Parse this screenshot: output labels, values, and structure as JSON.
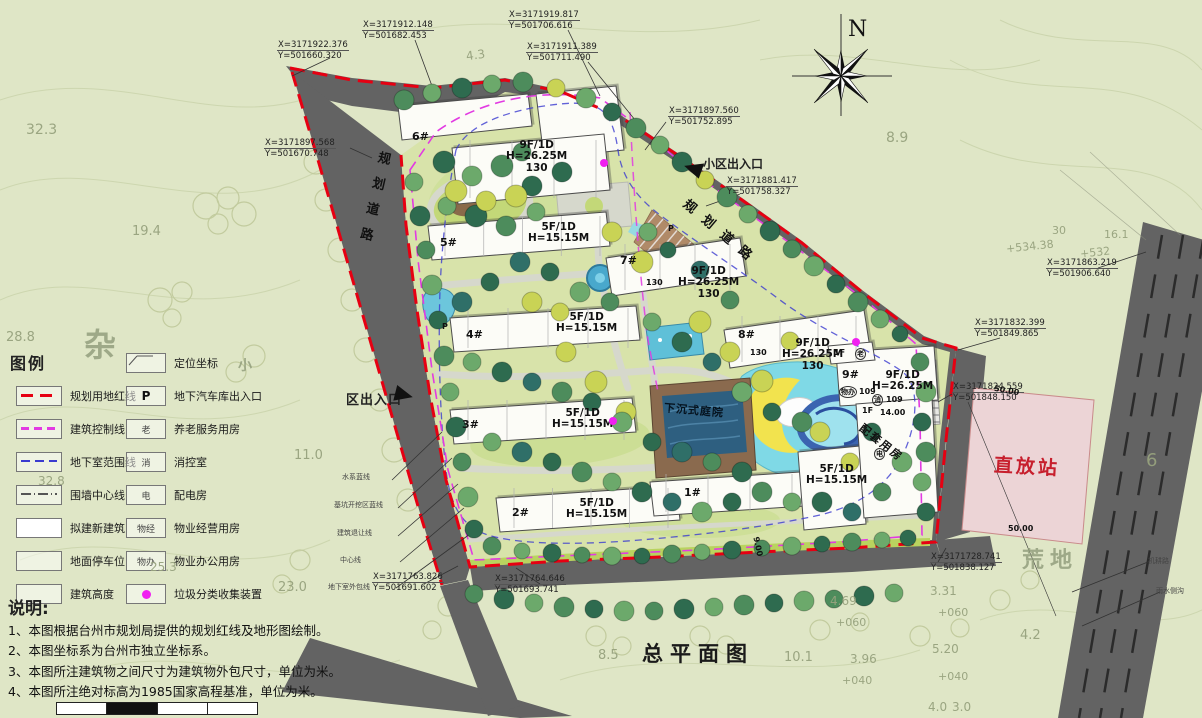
{
  "title": "总平面图",
  "compass_label": "N",
  "legend": {
    "title": "图例",
    "left_items": [
      {
        "label": "规划用地红线",
        "swatch": "red-dash"
      },
      {
        "label": "建筑控制线",
        "swatch": "magenta-dash"
      },
      {
        "label": "地下室范围线",
        "swatch": "blue-dash"
      },
      {
        "label": "围墙中心线",
        "swatch": "wall-line"
      },
      {
        "label": "拟建新建筑",
        "swatch": "building"
      },
      {
        "label": "地面停车位",
        "swatch": "parking"
      },
      {
        "label": "建筑高度",
        "swatch": "empty"
      }
    ],
    "right_items": [
      {
        "label": "定位坐标",
        "symbol": ""
      },
      {
        "label": "地下汽车库出入口",
        "symbol": "P"
      },
      {
        "label": "养老服务用房",
        "symbol": "老"
      },
      {
        "label": "消控室",
        "symbol": "消"
      },
      {
        "label": "配电房",
        "symbol": "电"
      },
      {
        "label": "物业经营用房",
        "symbol": "物经"
      },
      {
        "label": "物业办公用房",
        "symbol": "物办"
      },
      {
        "label": "垃圾分类收集装置",
        "symbol": ""
      }
    ]
  },
  "notes": {
    "title": "说明:",
    "items": [
      "1、本图根据台州市规划局提供的规划红线及地形图绘制。",
      "2、本图坐标系为台州市独立坐标系。",
      "3、本图所注建筑物之间尺寸为建筑物外包尺寸，单位为米。",
      "4、本图所注绝对标高为1985国家高程基准，单位为米。"
    ]
  },
  "roads": {
    "left_road_label": "规划道路",
    "right_road_label": "规划道路"
  },
  "entrances": {
    "main": "小区出入口",
    "secondary": "区出入口"
  },
  "places": {
    "sunken_courtyard": "下沉式庭院",
    "support_building": "配套用房",
    "repeater_station": "直放站"
  },
  "coords": [
    {
      "x": "X=3171922.376",
      "y": "Y=501660.320",
      "px": 277,
      "py": 40
    },
    {
      "x": "X=3171912.148",
      "y": "Y=501682.453",
      "px": 362,
      "py": 20
    },
    {
      "x": "X=3171919.817",
      "y": "Y=501706.616",
      "px": 508,
      "py": 10
    },
    {
      "x": "X=3171911.389",
      "y": "Y=501711.490",
      "px": 526,
      "py": 42
    },
    {
      "x": "X=3171897.560",
      "y": "Y=501752.895",
      "px": 668,
      "py": 106
    },
    {
      "x": "X=3171881.417",
      "y": "Y=501758.327",
      "px": 726,
      "py": 176
    },
    {
      "x": "X=3171897.568",
      "y": "Y=501670.748",
      "px": 264,
      "py": 138
    },
    {
      "x": "X=3171863.219",
      "y": "Y=501906.640",
      "px": 1046,
      "py": 258
    },
    {
      "x": "X=3171832.399",
      "y": "Y=501849.865",
      "px": 974,
      "py": 318
    },
    {
      "x": "X=3171824.559",
      "y": "Y=501848.150",
      "px": 952,
      "py": 382
    },
    {
      "x": "X=3171763.826",
      "y": "Y=501691.602",
      "px": 372,
      "py": 572
    },
    {
      "x": "X=3171764.646",
      "y": "Y=501693.741",
      "px": 494,
      "py": 574
    },
    {
      "x": "X=3171728.741",
      "y": "Y=501838.127",
      "px": 930,
      "py": 552
    }
  ],
  "building_numbers": [
    {
      "t": "6#",
      "px": 412,
      "py": 130
    },
    {
      "t": "5#",
      "px": 440,
      "py": 236
    },
    {
      "t": "7#",
      "px": 620,
      "py": 254
    },
    {
      "t": "8#",
      "px": 738,
      "py": 328
    },
    {
      "t": "4#",
      "px": 466,
      "py": 328
    },
    {
      "t": "3#",
      "px": 462,
      "py": 418
    },
    {
      "t": "2#",
      "px": 512,
      "py": 506
    },
    {
      "t": "1#",
      "px": 684,
      "py": 486
    },
    {
      "t": "9#",
      "px": 842,
      "py": 368
    }
  ],
  "spec_labels": [
    {
      "lines": [
        "9F/1D",
        "H=26.25M",
        "130"
      ],
      "px": 506,
      "py": 140
    },
    {
      "lines": [
        "5F/1D",
        "H=15.15M"
      ],
      "px": 528,
      "py": 222
    },
    {
      "lines": [
        "9F/1D",
        "H=26.25M",
        "130"
      ],
      "px": 678,
      "py": 266
    },
    {
      "lines": [
        "9F/1D",
        "H=26.25M",
        "130"
      ],
      "px": 782,
      "py": 338
    },
    {
      "lines": [
        "9F/1D",
        "H=26.25M"
      ],
      "px": 872,
      "py": 370
    },
    {
      "lines": [
        "5F/1D",
        "H=15.15M"
      ],
      "px": 556,
      "py": 312
    },
    {
      "lines": [
        "5F/1D",
        "H=15.15M"
      ],
      "px": 552,
      "py": 408
    },
    {
      "lines": [
        "5F/1D",
        "H=15.15M"
      ],
      "px": 566,
      "py": 498
    },
    {
      "lines": [
        "5F/1D",
        "H=15.15M"
      ],
      "px": 806,
      "py": 464
    }
  ],
  "micro_labels": [
    {
      "t": "130",
      "px": 646,
      "py": 278
    },
    {
      "t": "130",
      "px": 750,
      "py": 348
    },
    {
      "t": "1F",
      "px": 834,
      "py": 348
    },
    {
      "t": "老",
      "px": 855,
      "py": 348,
      "circ": true
    },
    {
      "t": "物办",
      "px": 839,
      "py": 386,
      "circ": true
    },
    {
      "t": "109",
      "px": 859,
      "py": 387
    },
    {
      "t": "消",
      "px": 872,
      "py": 394,
      "circ": true
    },
    {
      "t": "109",
      "px": 886,
      "py": 395
    },
    {
      "t": "1F",
      "px": 862,
      "py": 406
    },
    {
      "t": "14.00",
      "px": 880,
      "py": 408
    },
    {
      "t": "电",
      "px": 874,
      "py": 448,
      "circ": true
    },
    {
      "t": "P",
      "px": 442,
      "py": 322
    },
    {
      "t": "P",
      "px": 668,
      "py": 224
    },
    {
      "t": "50.00",
      "px": 994,
      "py": 386,
      "rot": 10
    },
    {
      "t": "50.00",
      "px": 1008,
      "py": 524
    },
    {
      "t": "9.00",
      "px": 748,
      "py": 542,
      "rot": 78
    }
  ],
  "boundary_line_labels": [
    {
      "t": "水系蓝线",
      "px": 342,
      "py": 472
    },
    {
      "t": "基坑开挖区蓝线",
      "px": 334,
      "py": 500
    },
    {
      "t": "建筑退让线",
      "px": 337,
      "py": 528
    },
    {
      "t": "中心线",
      "px": 340,
      "py": 555
    },
    {
      "t": "地下室外包线",
      "px": 328,
      "py": 582
    }
  ],
  "edge_labels": [
    {
      "t": "机耕路",
      "px": 1148,
      "py": 556
    },
    {
      "t": "雨水侧沟",
      "px": 1156,
      "py": 586
    }
  ],
  "bg_chars": [
    {
      "t": "杂",
      "px": 84,
      "py": 320,
      "fs": 32
    },
    {
      "t": "荒地",
      "px": 1022,
      "py": 542,
      "fs": 22,
      "ls": 6
    },
    {
      "t": "小",
      "px": 238,
      "py": 355,
      "fs": 14
    }
  ],
  "terrain_labels": [
    {
      "t": "32.3",
      "px": 26,
      "py": 122,
      "fs": 14
    },
    {
      "t": "19.4",
      "px": 132,
      "py": 224,
      "fs": 13
    },
    {
      "t": "28.8",
      "px": 6,
      "py": 330,
      "fs": 13
    },
    {
      "t": "11.0",
      "px": 294,
      "py": 448,
      "fs": 13
    },
    {
      "t": "23.0",
      "px": 278,
      "py": 580,
      "fs": 13
    },
    {
      "t": "25.3",
      "px": 150,
      "py": 560,
      "fs": 12
    },
    {
      "t": "32.8",
      "px": 38,
      "py": 474,
      "fs": 12
    },
    {
      "t": "4.3",
      "px": 466,
      "py": 48,
      "fs": 12,
      "rot": -8
    },
    {
      "t": "8.9",
      "px": 886,
      "py": 130,
      "fs": 14
    },
    {
      "t": "30",
      "px": 1052,
      "py": 224,
      "fs": 11
    },
    {
      "t": "16.1",
      "px": 1104,
      "py": 228,
      "fs": 11
    },
    {
      "t": "+534.38",
      "px": 1006,
      "py": 240,
      "fs": 11,
      "rot": -6
    },
    {
      "t": "+532",
      "px": 1080,
      "py": 246,
      "fs": 11,
      "rot": -6
    },
    {
      "t": "8.5",
      "px": 598,
      "py": 648,
      "fs": 13
    },
    {
      "t": "10.1",
      "px": 784,
      "py": 650,
      "fs": 13
    },
    {
      "t": "3.96",
      "px": 850,
      "py": 652,
      "fs": 12
    },
    {
      "t": "4.69",
      "px": 830,
      "py": 594,
      "fs": 12
    },
    {
      "t": "+060",
      "px": 836,
      "py": 616,
      "fs": 11
    },
    {
      "t": "+040",
      "px": 842,
      "py": 674,
      "fs": 11
    },
    {
      "t": "3.31",
      "px": 930,
      "py": 584,
      "fs": 12
    },
    {
      "t": "+060",
      "px": 938,
      "py": 606,
      "fs": 11
    },
    {
      "t": "4.2",
      "px": 1020,
      "py": 628,
      "fs": 13
    },
    {
      "t": "5.20",
      "px": 932,
      "py": 642,
      "fs": 12
    },
    {
      "t": "+040",
      "px": 938,
      "py": 670,
      "fs": 11
    },
    {
      "t": "4.0",
      "px": 928,
      "py": 700,
      "fs": 12
    },
    {
      "t": "3.0",
      "px": 952,
      "py": 700,
      "fs": 12
    },
    {
      "t": "6",
      "px": 1146,
      "py": 450,
      "fs": 18
    }
  ],
  "dots": [
    {
      "px": 604,
      "py": 163
    },
    {
      "px": 856,
      "py": 342
    },
    {
      "px": 613,
      "py": 421
    }
  ],
  "colors": {
    "red_line": "#e60012",
    "control_line": "#e23ae2",
    "basement_line": "#3b3bd0",
    "road": "#636363",
    "site_green": "#d8e3aa",
    "background": "#dfe6c6",
    "water": "#5fc0d8",
    "repeater_fill": "#ecd4d6",
    "repeater_text": "#c71f2d",
    "garbage_dot": "#f020f0"
  }
}
